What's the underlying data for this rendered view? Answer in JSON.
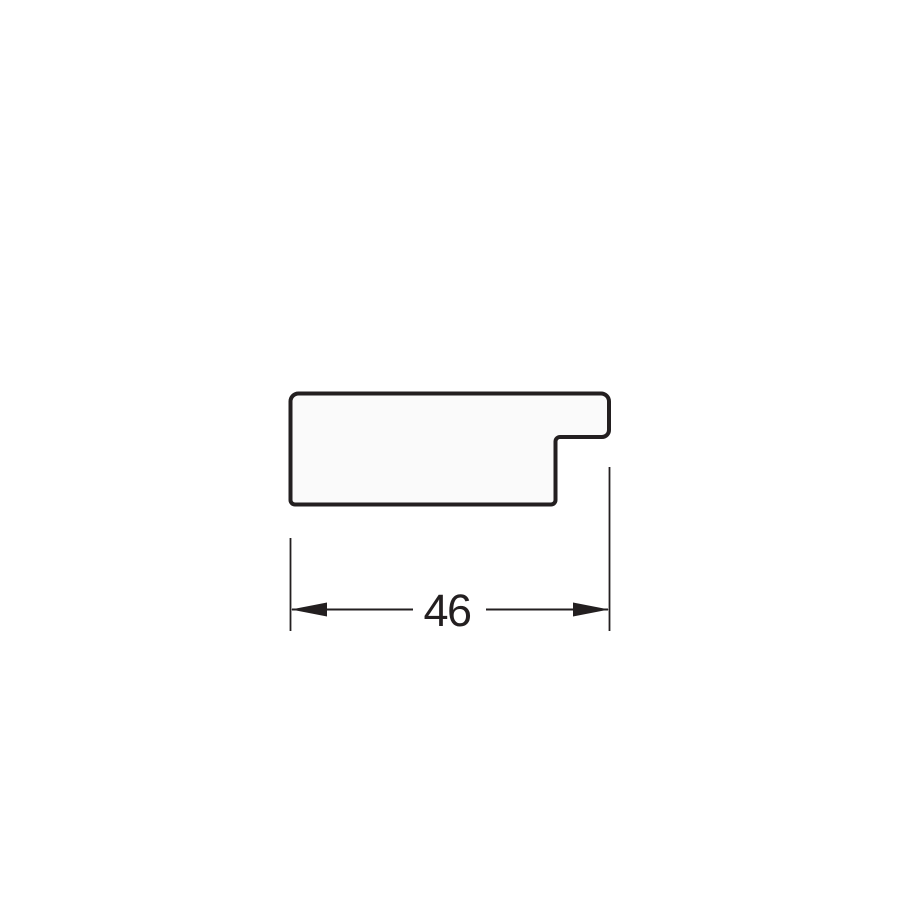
{
  "diagram": {
    "dimension_label": "46",
    "colors": {
      "line": "#231f20",
      "profile_fill": "#fafafa",
      "background": "#ffffff"
    }
  }
}
